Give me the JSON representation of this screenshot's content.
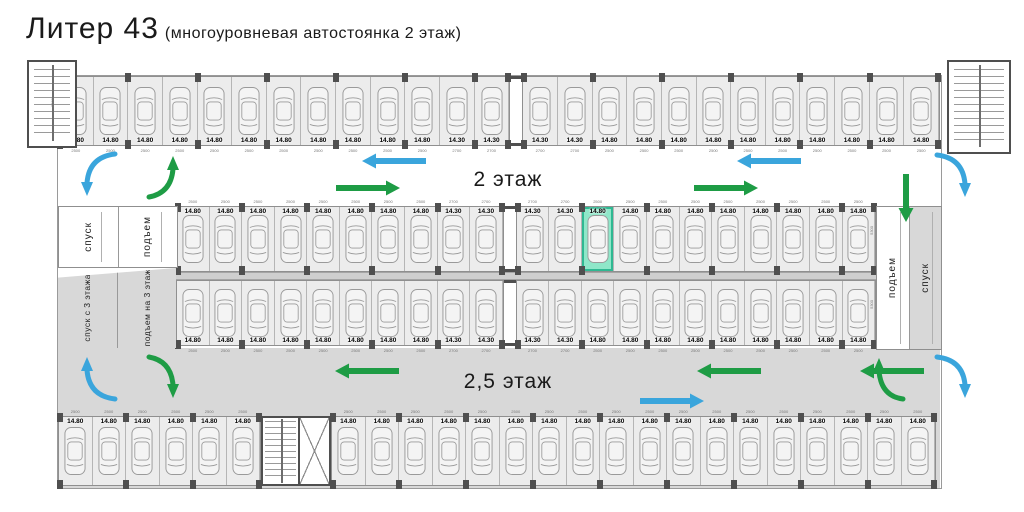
{
  "title": {
    "main": "Литер 43",
    "subtitle": "(многоуровневая автостоянка 2 этаж)"
  },
  "floor_labels": {
    "upper": "2 этаж",
    "lower": "2,5 этаж"
  },
  "ramps": {
    "left_top": {
      "labels": [
        "спуск",
        "подъем"
      ]
    },
    "left_bottom": {
      "labels": [
        "спуск с 3 этажа",
        "подъем на 3 этаж"
      ]
    },
    "right": {
      "labels": [
        "подъем",
        "спуск"
      ]
    }
  },
  "rows": {
    "top": {
      "segments": [
        [
          {
            "l": "14.80",
            "d": "2500",
            "n": 11
          },
          {
            "l": "14.30",
            "d": "2700",
            "n": 2
          }
        ],
        [
          {
            "l": "14.30",
            "d": "2700",
            "n": 2
          },
          {
            "l": "14.80",
            "d": "2500",
            "n": 10
          }
        ]
      ]
    },
    "middle_top": {
      "segments": [
        [
          {
            "l": "14.80",
            "d": "2500",
            "n": 8
          },
          {
            "l": "14.30",
            "d": "2700",
            "n": 2
          }
        ],
        [
          {
            "l": "14.30",
            "d": "2700",
            "n": 2
          },
          {
            "l": "14.80",
            "d": "2500",
            "n": 1,
            "highlight": true
          },
          {
            "l": "14.80",
            "d": "2500",
            "n": 8
          }
        ]
      ]
    },
    "middle_bottom": {
      "segments": [
        [
          {
            "l": "14.80",
            "d": "2500",
            "n": 8
          },
          {
            "l": "14.30",
            "d": "2700",
            "n": 2
          }
        ],
        [
          {
            "l": "14.30",
            "d": "2700",
            "n": 2
          },
          {
            "l": "14.80",
            "d": "2500",
            "n": 9
          }
        ]
      ]
    },
    "bottom": {
      "segments": [
        [
          {
            "l": "14.80",
            "d": "2500",
            "n": 6
          }
        ],
        [
          {
            "l": "14.80",
            "d": "2500",
            "n": 18
          }
        ]
      ]
    }
  },
  "side_dims": [
    "5300",
    "5300",
    "5300"
  ],
  "highlight": {
    "row": "middle_top",
    "label": "14.80"
  },
  "arrows": [
    {
      "area": "upper_aisle",
      "color": "blue",
      "direction": "left",
      "count": 2
    },
    {
      "area": "upper_aisle",
      "color": "green",
      "direction": "right",
      "count": 2
    },
    {
      "area": "upper_left_corner",
      "color": "blue",
      "direction": "curve-down"
    },
    {
      "area": "upper_left_corner",
      "color": "green",
      "direction": "curve-up"
    },
    {
      "area": "upper_right_ramp",
      "color": "green",
      "direction": "down"
    },
    {
      "area": "upper_right_corner",
      "color": "blue",
      "direction": "curve-down"
    },
    {
      "area": "lower_aisle",
      "color": "green",
      "direction": "left",
      "count": 3
    },
    {
      "area": "lower_aisle",
      "color": "blue",
      "direction": "right",
      "count": 1
    },
    {
      "area": "lower_left_corner",
      "color": "blue",
      "direction": "curve-up"
    },
    {
      "area": "lower_left_corner",
      "color": "green",
      "direction": "curve-down"
    },
    {
      "area": "lower_right_corner",
      "color": "green",
      "direction": "curve-up"
    },
    {
      "area": "lower_right_corner",
      "color": "blue",
      "direction": "curve-down"
    }
  ],
  "colors": {
    "arrow_blue": "#3AA5DC",
    "arrow_green": "#1E9C45",
    "highlight_fill": "#8FE7C9",
    "highlight_border": "#2FB892",
    "column": "#4F4F4F",
    "band_gray": "#D8D8D8",
    "spot_fill": "#ECECEC"
  }
}
